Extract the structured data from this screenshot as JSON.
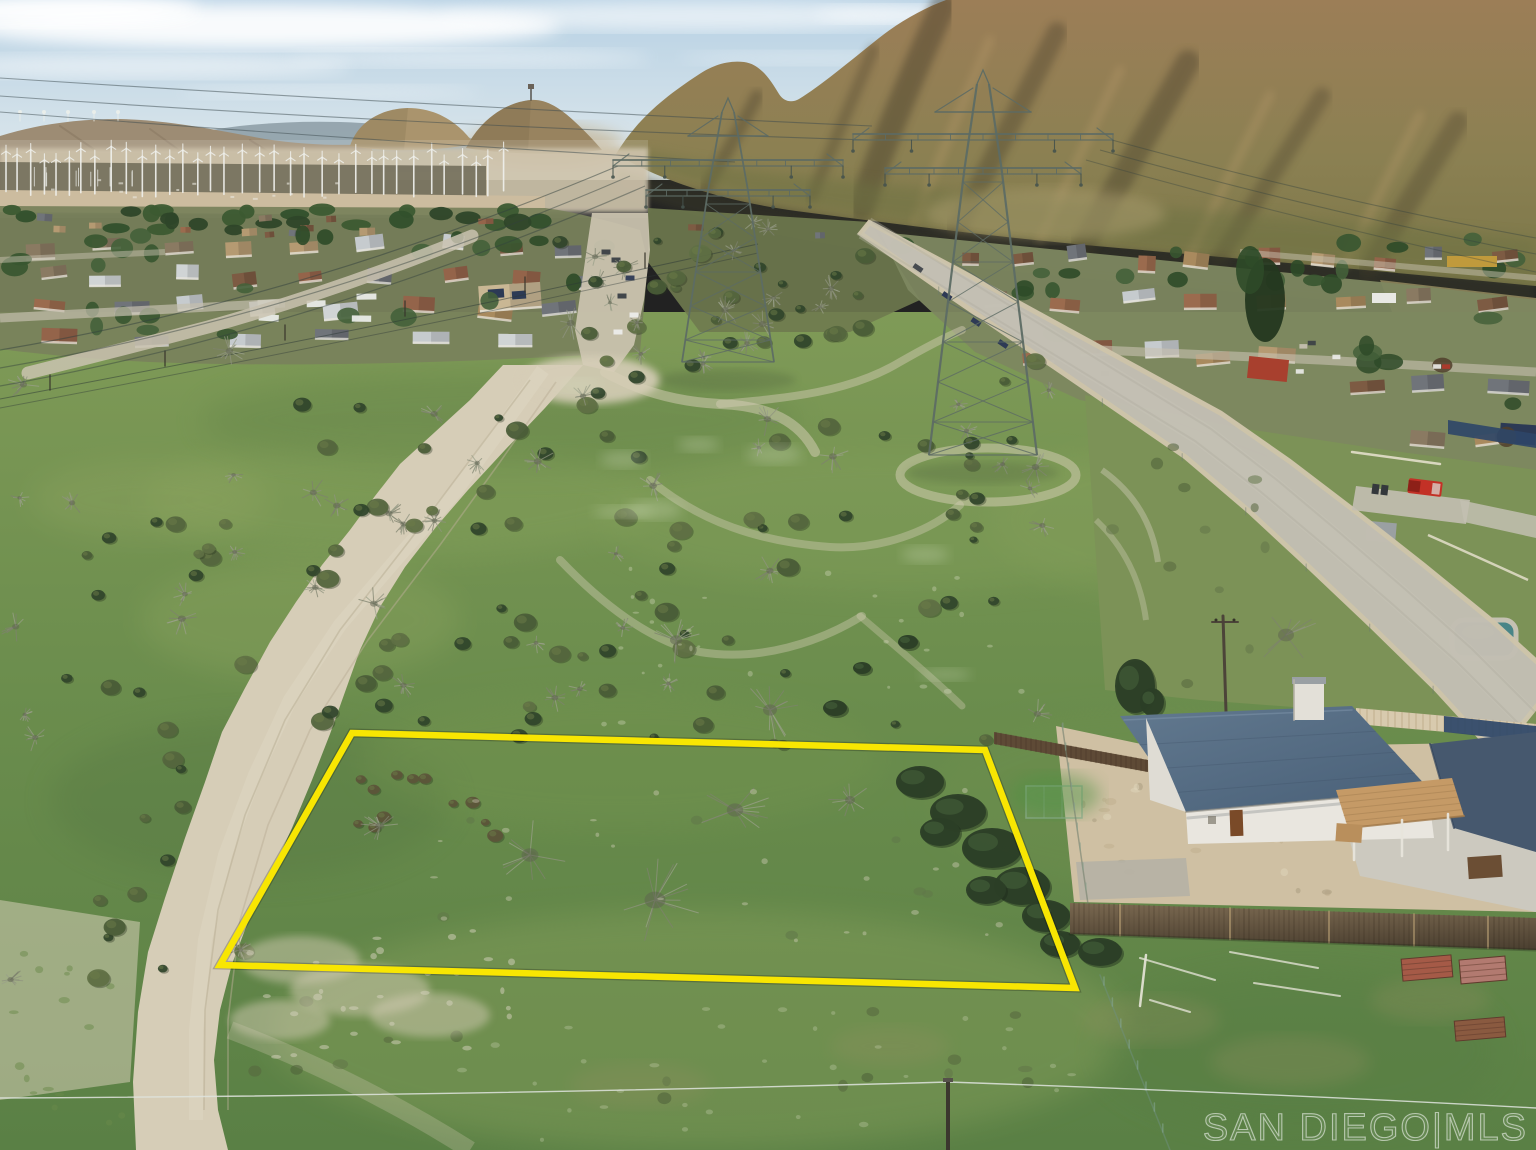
{
  "watermark": {
    "text": "SAN DIEGO|MLS"
  },
  "scene": {
    "description": "Aerial drone photograph of a vacant high-desert land parcel outlined in yellow, beside a dirt road, with a residential community, a wind-turbine farm, rocky mountains, and two large power transmission towers; a white house with a blue roof and wooden fence sits at lower right.",
    "elements": [
      "sky with wispy clouds",
      "distant mountain ridges",
      "large sunlit rocky mountain",
      "row of white wind turbines",
      "residential neighborhood with trees",
      "two steel lattice transmission towers with power lines",
      "paved road running diagonally to the right",
      "curving sandy dirt road at left",
      "green scrubland with bushes and trails",
      "yellow property boundary outline",
      "white house with blue roof, patio and wood fence",
      "red pickup truck",
      "utility pole and wire at bottom",
      "SAN DIEGO MLS watermark"
    ]
  },
  "palette": {
    "sky_top": "#b7d1e4",
    "sky_horizon": "#e0e9ec",
    "cloud": "#ffffff",
    "mountain_far": "#9d8c74",
    "mountain_far_blue": "#8fa0a8",
    "hill_tan": "#aa946d",
    "hill_point": "#98835f",
    "mountain_hi": "#9c7e57",
    "mountain_lo": "#7b7749",
    "mountain_shadow": "#3f3926",
    "mountain_light": "#c2a271",
    "valley_haze": "#c6b99d",
    "turbine_white": "#eff0ec",
    "grass_light": "#7f9a57",
    "grass_mid": "#6b8d4d",
    "grass_dark": "#587e44",
    "bush_dark": "#2c3e26",
    "bush_olive": "#55663e",
    "bush_twig": "#8f937f",
    "bush_brown": "#5c5539",
    "dirt": "#d6cdb7",
    "dirt_rut": "#b9ae95",
    "road_paved": "#c2beb2",
    "road_shoulder": "#cfc5ab",
    "tower_steel": "#5d6b64",
    "wire_dark": "#32403e",
    "roof_blue": "#57708a",
    "roof_blue_dark": "#46586e",
    "wall_white": "#e9e6df",
    "patio_tan": "#c59a66",
    "concrete": "#ccc9bf",
    "yard_dirt": "#cfc0a3",
    "fence_wood": "#5f4e3b",
    "fence_light": "#d8caae",
    "fence_navy": "#2e4668",
    "boundary_yellow": "#f8e602",
    "truck_red": "#c33126",
    "pool_teal": "#47858a",
    "wire_light": "#dfe4de"
  }
}
